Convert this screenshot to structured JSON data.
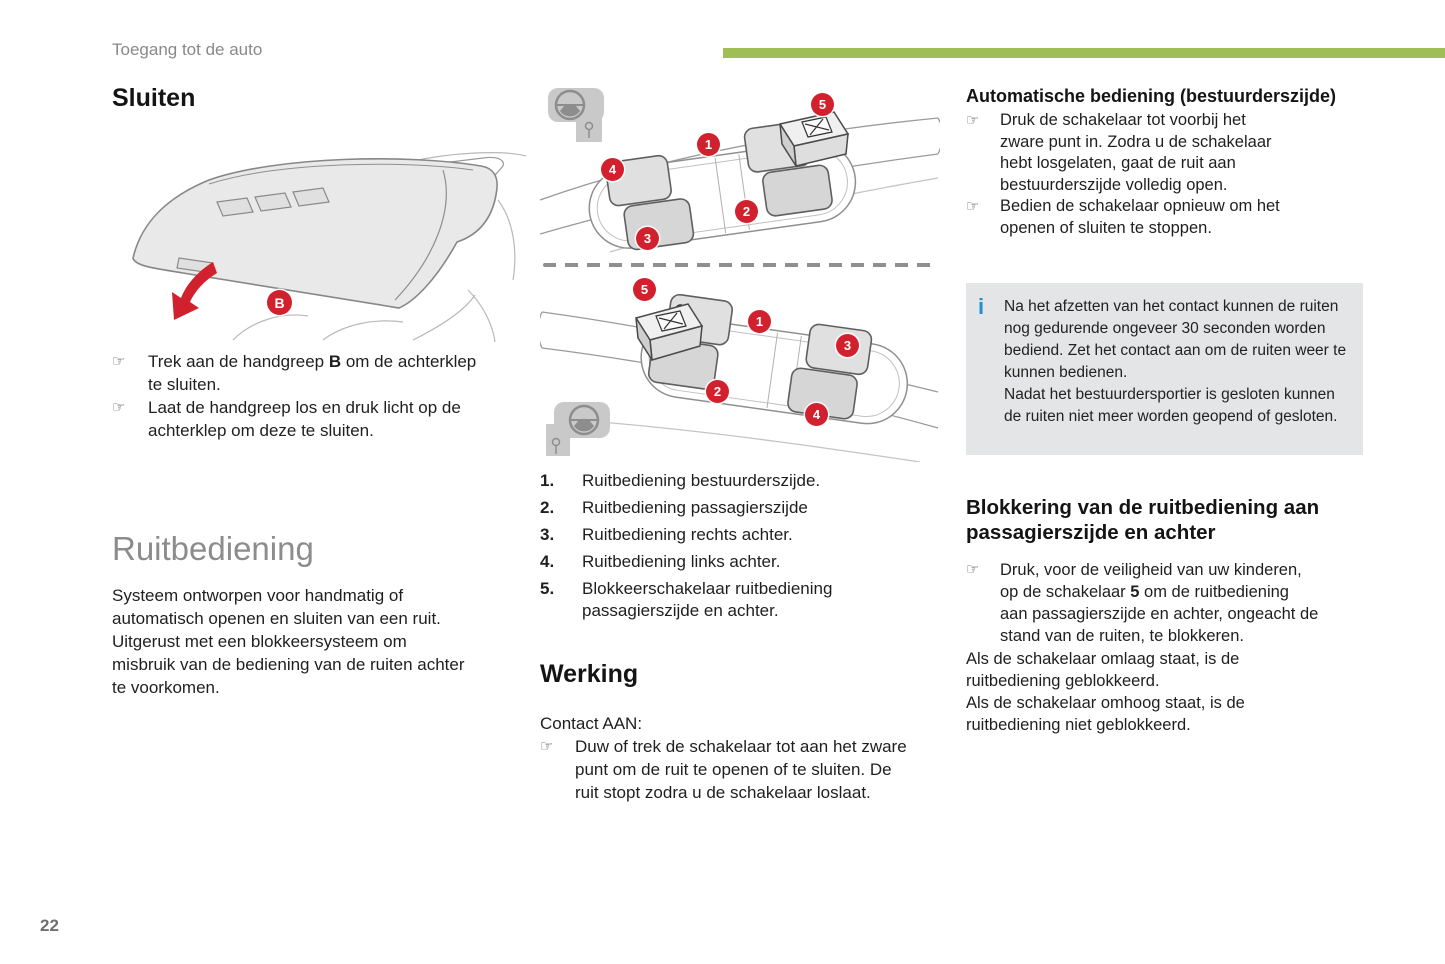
{
  "header": {
    "breadcrumb": "Toegang tot de auto"
  },
  "footer": {
    "page_number": "22"
  },
  "ui": {
    "bullet_glyph": "☞"
  },
  "colors": {
    "accent_green": "#9fbe55",
    "badge_red": "#d2212e",
    "info_blue": "#1f93d1",
    "heading_gray": "#8c8c8c"
  },
  "left": {
    "sluiten_title": "Sluiten",
    "tailgate_label": "B",
    "bullet1_pre": "Trek aan de handgreep ",
    "bullet1_bold": "B",
    "bullet1_post": " om de achterklep te sluiten.",
    "bullet2": "Laat de handgreep los en druk licht op de achterklep om deze te sluiten.",
    "ruitbediening_title": "Ruitbediening",
    "ruitbediening_body": "Systeem ontworpen voor handmatig of automatisch openen en sluiten van een ruit. Uitgerust met een blokkeersysteem om misbruik van de bediening van de ruiten achter te voorkomen."
  },
  "middle": {
    "top_badges": {
      "b1": "1",
      "b2": "2",
      "b3": "3",
      "b4": "4",
      "b5": "5"
    },
    "bottom_badges": {
      "b1": "1",
      "b2": "2",
      "b3": "3",
      "b4": "4",
      "b5": "5"
    },
    "legend": [
      {
        "num": "1.",
        "text": "Ruitbediening bestuurderszijde."
      },
      {
        "num": "2.",
        "text": "Ruitbediening passagierszijde"
      },
      {
        "num": "3.",
        "text": "Ruitbediening rechts achter."
      },
      {
        "num": "4.",
        "text": "Ruitbediening links achter."
      },
      {
        "num": "5.",
        "text": "Blokkeerschakelaar ruitbediening passagierszijde en achter."
      }
    ],
    "werking_title": "Werking",
    "contact_line": "Contact AAN:",
    "werking_bullet": "Duw of trek de schakelaar tot aan het zware punt om de ruit te openen of te sluiten. De ruit stopt zodra u de schakelaar loslaat."
  },
  "right": {
    "auto_title": "Automatische bediening (bestuurderszijde)",
    "auto_bullet1": "Druk de schakelaar tot voorbij het zware punt in. Zodra u de schakelaar hebt losgelaten, gaat de ruit aan bestuurderszijde volledig open.",
    "auto_bullet2": "Bedien de schakelaar opnieuw om het openen of sluiten te stoppen.",
    "info_icon": "i",
    "info_text1": "Na het afzetten van het contact kunnen de ruiten nog gedurende ongeveer 30 seconden worden bediend. Zet het contact aan om de ruiten weer te kunnen bedienen.",
    "info_text2": "Nadat het bestuurdersportier is gesloten kunnen de ruiten niet meer worden geopend of gesloten.",
    "blok_title": "Blokkering van de ruitbediening aan passagierszijde en achter",
    "blok_bullet_pre": "Druk, voor de veiligheid van uw kinderen, op de schakelaar ",
    "blok_bullet_bold": "5",
    "blok_bullet_post": " om de ruitbediening aan passagierszijde en achter, ongeacht de stand van de ruiten, te blokkeren.",
    "blok_par1": "Als de schakelaar omlaag staat, is de ruitbediening geblokkeerd.",
    "blok_par2": "Als de schakelaar omhoog staat, is de ruitbediening niet geblokkeerd."
  }
}
